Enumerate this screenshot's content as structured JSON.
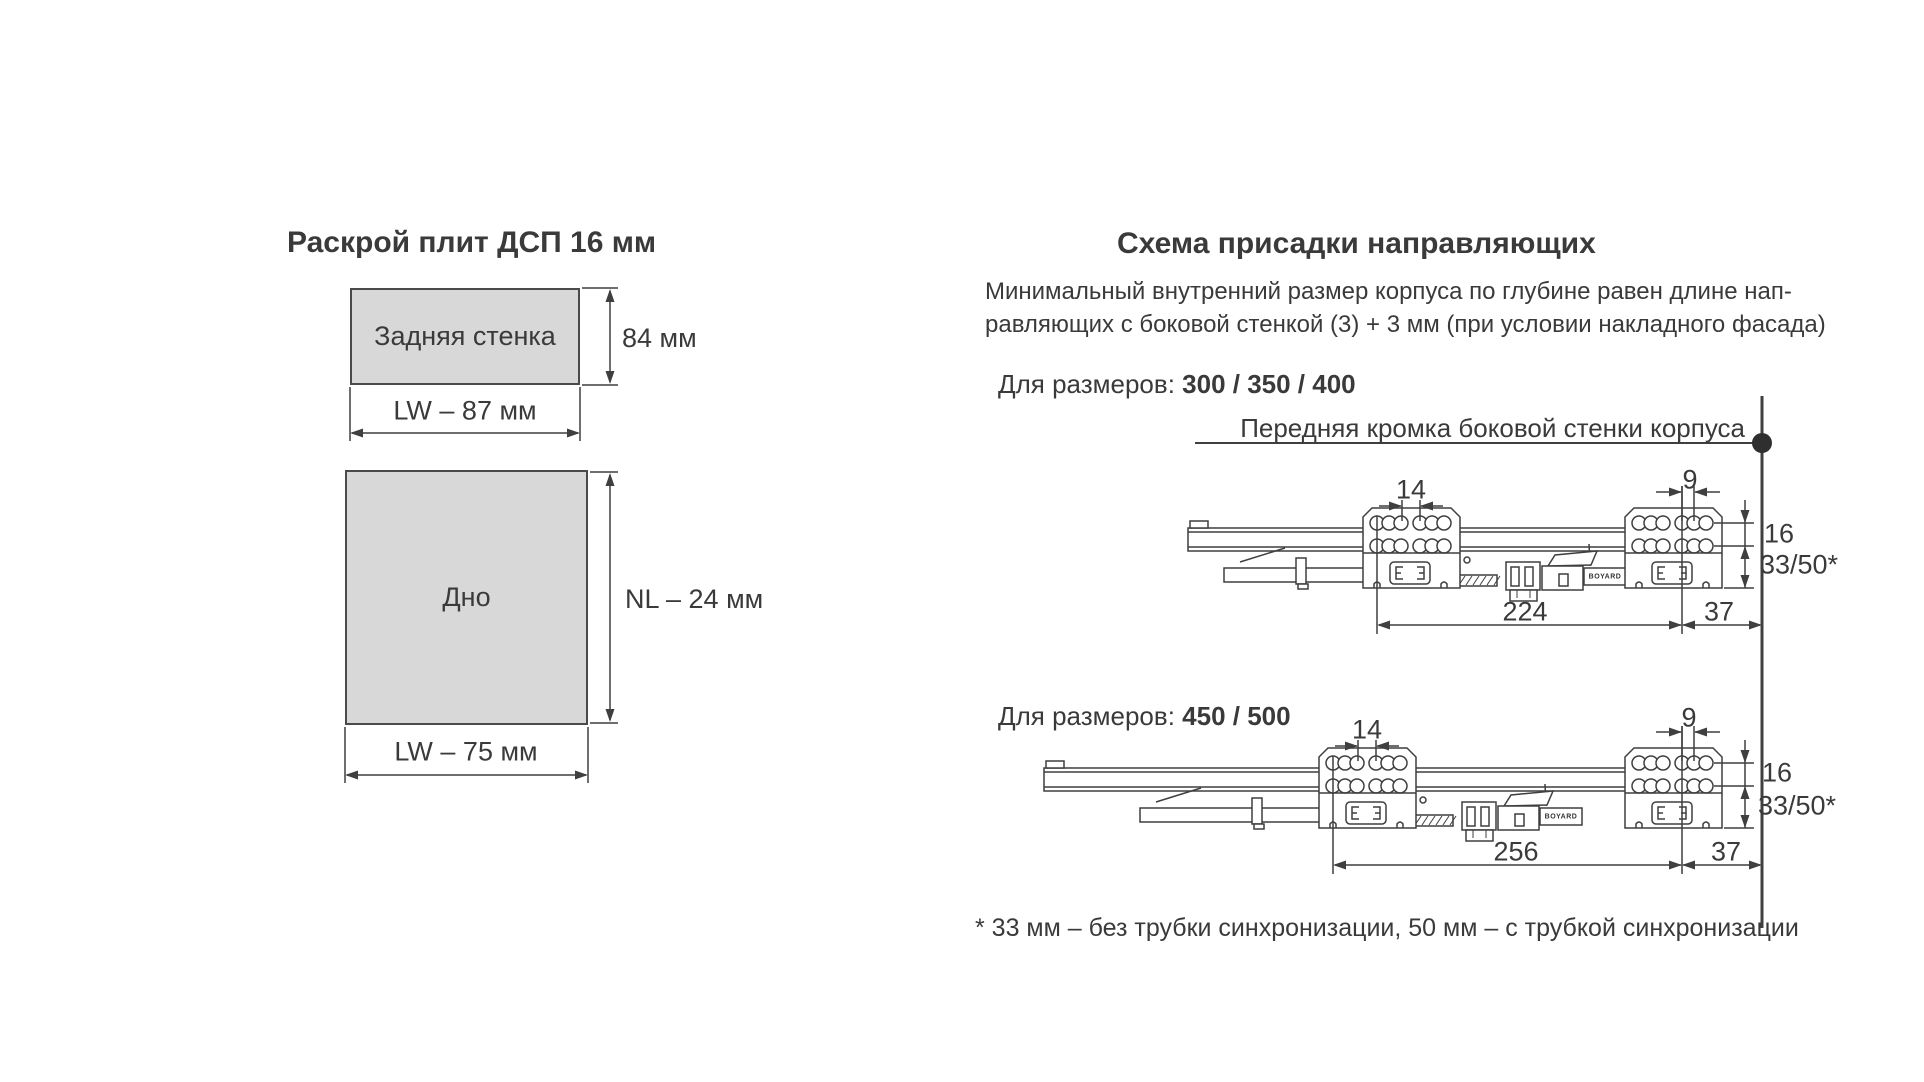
{
  "left": {
    "title": "Раскрой плит ДСП 16 мм",
    "back_panel": {
      "label": "Задняя стенка",
      "height_dim": "84 мм",
      "width_dim": "LW – 87 мм"
    },
    "bottom_panel": {
      "label": "Дно",
      "height_dim": "NL – 24 мм",
      "width_dim": "LW – 75 мм"
    }
  },
  "right": {
    "title": "Схема присадки направляющих",
    "note_line1": "Минимальный внутренний размер корпуса по глубине равен длине нап-",
    "note_line2": "равляющих с боковой стенкой (3) + 3 мм (при условии накладного фасада)",
    "front_edge_label": "Передняя кромка боковой стенки корпуса",
    "footnote": "* 33 мм – без трубки синхронизации, 50 мм – с трубкой синхронизации",
    "logo_text": "BOYARD",
    "section1": {
      "prefix": "Для размеров: ",
      "sizes": "300 / 350 / 400",
      "dims": {
        "hole_pitch_left": "14",
        "hole_pitch_right": "9",
        "row_spacing": "16",
        "edge_distance": "33/50*",
        "length": "224",
        "front_offset": "37"
      }
    },
    "section2": {
      "prefix": "Для размеров: ",
      "sizes": "450 / 500",
      "dims": {
        "hole_pitch_left": "14",
        "hole_pitch_right": "9",
        "row_spacing": "16",
        "edge_distance": "33/50*",
        "length": "256",
        "front_offset": "37"
      }
    }
  },
  "colors": {
    "line": "#3f3f3f",
    "panel_fill": "#d8d8d8",
    "text": "#3a3a3a"
  }
}
